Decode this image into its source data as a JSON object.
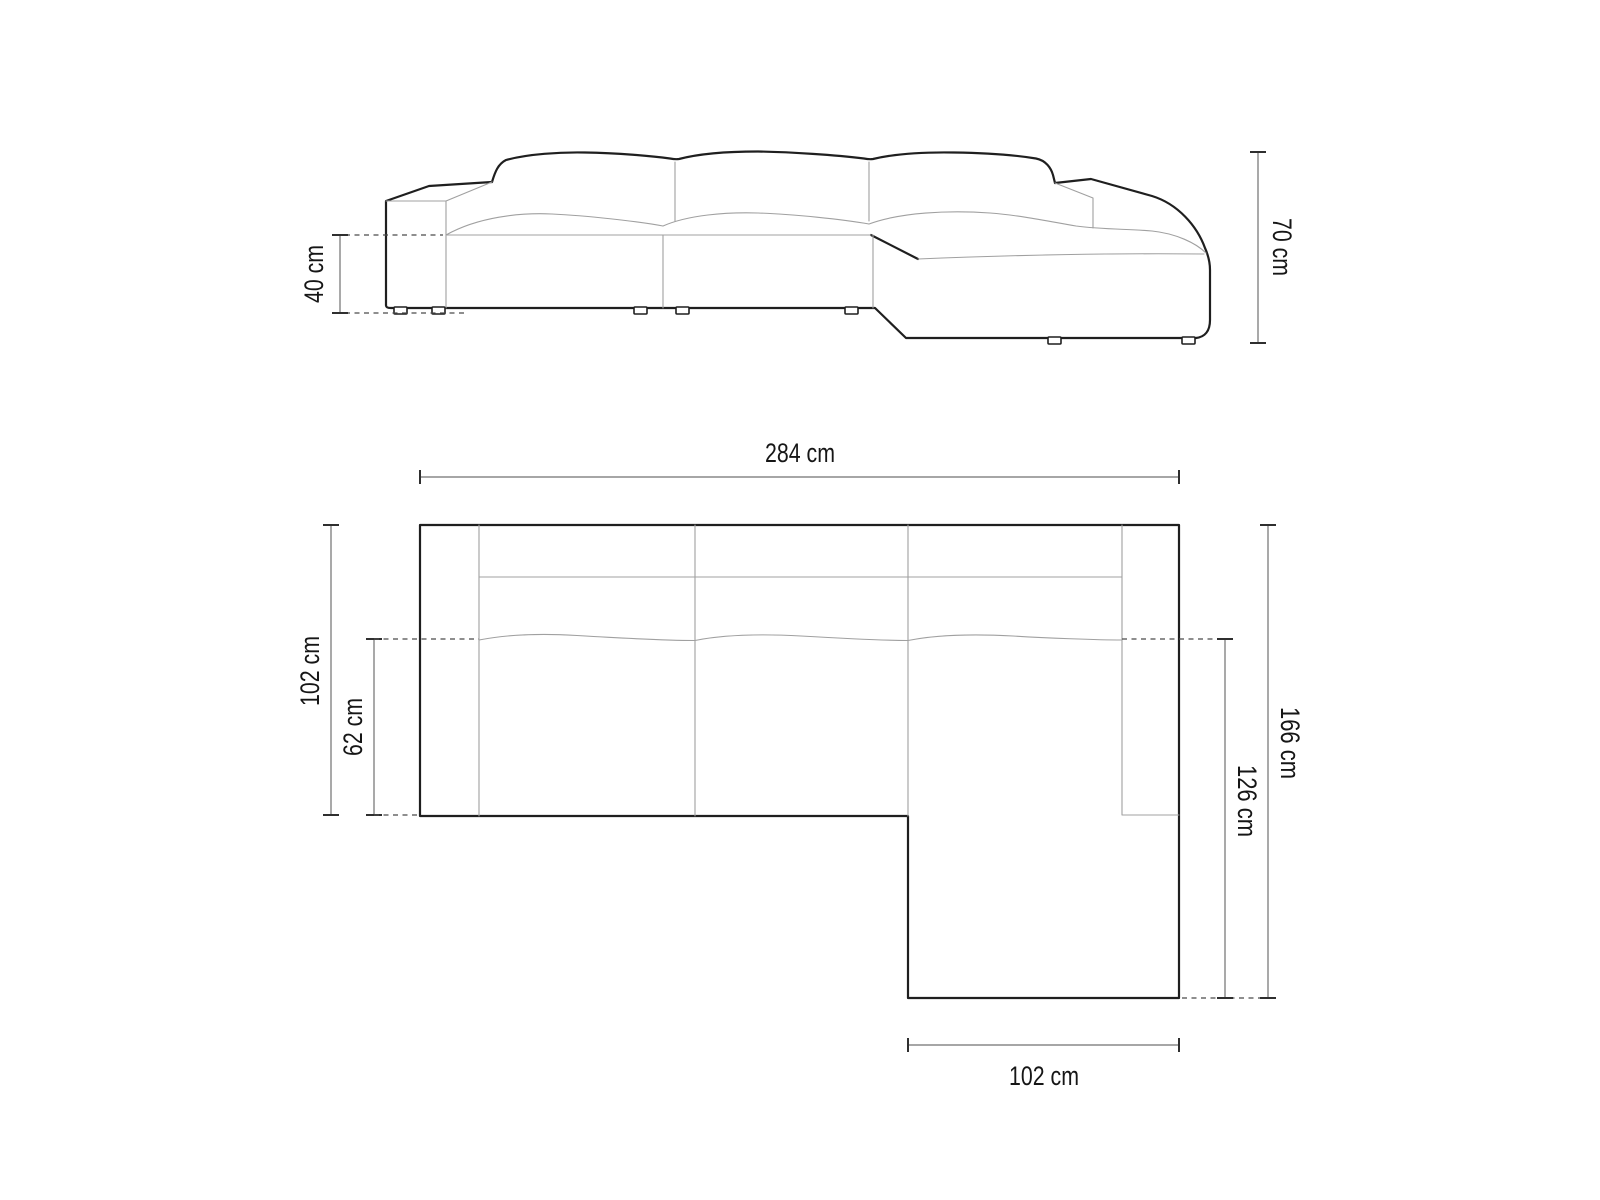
{
  "drawing": {
    "title": "corner-sofa-dimension-diagram",
    "views": {
      "front_elevation": {
        "labels": {
          "seat_height": "40 cm",
          "overall_height": "70 cm"
        },
        "values_cm": {
          "seat_height": 40,
          "overall_height": 70
        }
      },
      "top_plan": {
        "labels": {
          "overall_width": "284 cm",
          "overall_depth": "102 cm",
          "seat_depth": "62 cm",
          "chaise_overall_depth": "166 cm",
          "chaise_depth": "126 cm",
          "chaise_width": "102 cm"
        },
        "values_cm": {
          "overall_width": 284,
          "overall_depth": 102,
          "seat_depth": 62,
          "chaise_overall_depth": 166,
          "chaise_depth": 126,
          "chaise_width": 102
        }
      }
    },
    "colors": {
      "outline": "#1f1f1f",
      "detail": "#a0a0a0",
      "dim": "#707070",
      "cap": "#2f2f2f",
      "dash": "#4a4a4a",
      "text": "#161616",
      "bg": "#ffffff"
    }
  }
}
